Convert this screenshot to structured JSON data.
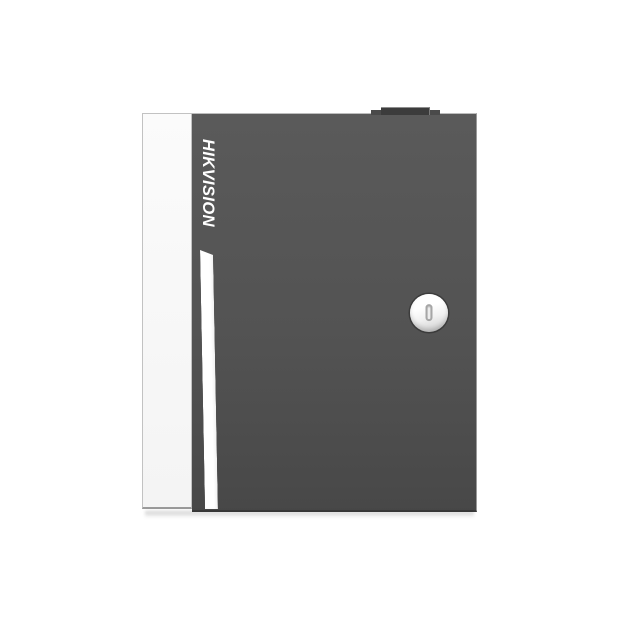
{
  "product": {
    "brand": "HIKVISION",
    "description": "Wall-mount metal enclosure (access controller cabinet), front product photo on white background",
    "parts": {
      "side_panel": "white left side panel",
      "door": "dark charcoal front door",
      "logo": "brand logotype rotated 90 degrees clockwise, reading top to bottom",
      "stripe": "vertical white decal stripe below logo",
      "lock": "circular cam lock with vertical keyhole slot",
      "knob": "small dark block on top edge"
    },
    "colors": {
      "bg": "#ffffff",
      "side_panel": "#fbfbfb",
      "door_top": "#5a5a5a",
      "door_bottom": "#484848",
      "logo": "#ffffff",
      "stripe": "#ffffff",
      "knob": "#3c3c3c",
      "lock_face": "#ffffff",
      "lock_slot_border": "#a6a6a6"
    }
  }
}
